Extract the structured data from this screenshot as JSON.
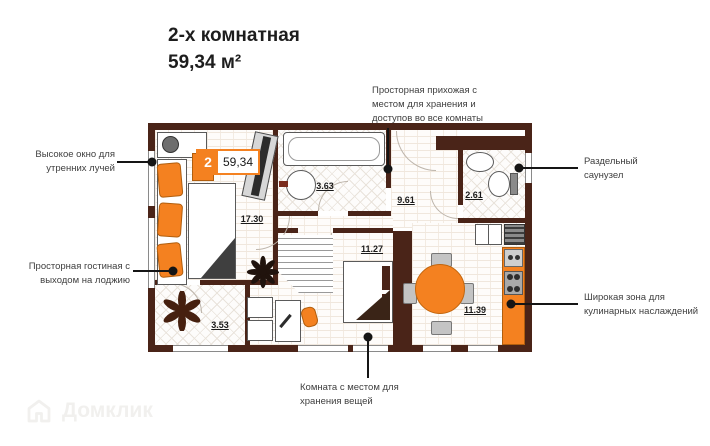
{
  "title": {
    "type": "2-х комнатная",
    "area": "59,34 м²"
  },
  "badge": {
    "rooms": "2",
    "area": "59,34"
  },
  "rooms": {
    "living": "17.30",
    "bathroom": "3.63",
    "hallway": "9.61",
    "wc": "2.61",
    "bedroom": "11.27",
    "kitchen": "11.39",
    "loggia": "3.53"
  },
  "annotations": {
    "window": "Высокое окно для утренних лучей",
    "hallway": "Просторная прихожая с местом для хранения и доступов во все комнаты",
    "living": "Просторная гостиная с выходом на лоджию",
    "bathroom": "Раздельный саунузел",
    "kitchen": "Широкая зона для кулинарных наслаждений",
    "bedroom": "Комната с местом для хранения вещей"
  },
  "watermark": {
    "label": "Домклик",
    "icon": "house-icon"
  },
  "colors": {
    "wall": "#4a2418",
    "accent": "#f48120",
    "callout": "#151515",
    "annotation": "#404040"
  }
}
